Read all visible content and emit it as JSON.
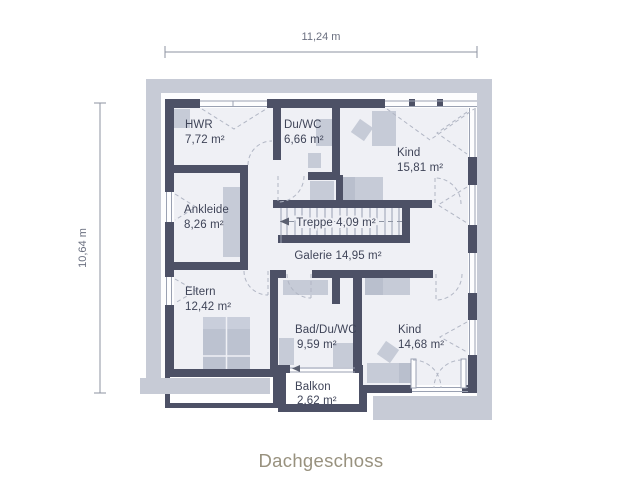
{
  "title": "Dachgeschoss",
  "dimensions": {
    "width_label": "11,24 m",
    "height_label": "10,64 m"
  },
  "rooms": [
    {
      "name": "HWR",
      "area": "7,72 m²"
    },
    {
      "name": "Du/WC",
      "area": "6,66 m²"
    },
    {
      "name": "Kind",
      "area": "15,81 m²"
    },
    {
      "name": "Ankleide",
      "area": "8,26 m²"
    },
    {
      "name": "Treppe",
      "area": "4,09 m²",
      "label": "Treppe 4,09 m²"
    },
    {
      "name": "Galerie",
      "area": "14,95 m²",
      "label": "Galerie 14,95 m²"
    },
    {
      "name": "Eltern",
      "area": "12,42 m²"
    },
    {
      "name": "Bad/Du/WC",
      "area": "9,59 m²"
    },
    {
      "name": "Kind",
      "area": "14,68 m²"
    },
    {
      "name": "Balkon",
      "area": "2,62 m²"
    }
  ],
  "colors": {
    "wall": "#4d5166",
    "roof_overhang": "#c7cbd6",
    "room_fill": "#eff0f5",
    "furniture": "#c6cbd7",
    "furniture_dark": "#b9bfcd",
    "label_text": "#3f4458",
    "dimension": "#6b7080",
    "dimension_line": "#8d93a2",
    "thin_line": "#9aa1b2",
    "dashed_line": "#b1b6c4",
    "title_text": "#98917e"
  }
}
